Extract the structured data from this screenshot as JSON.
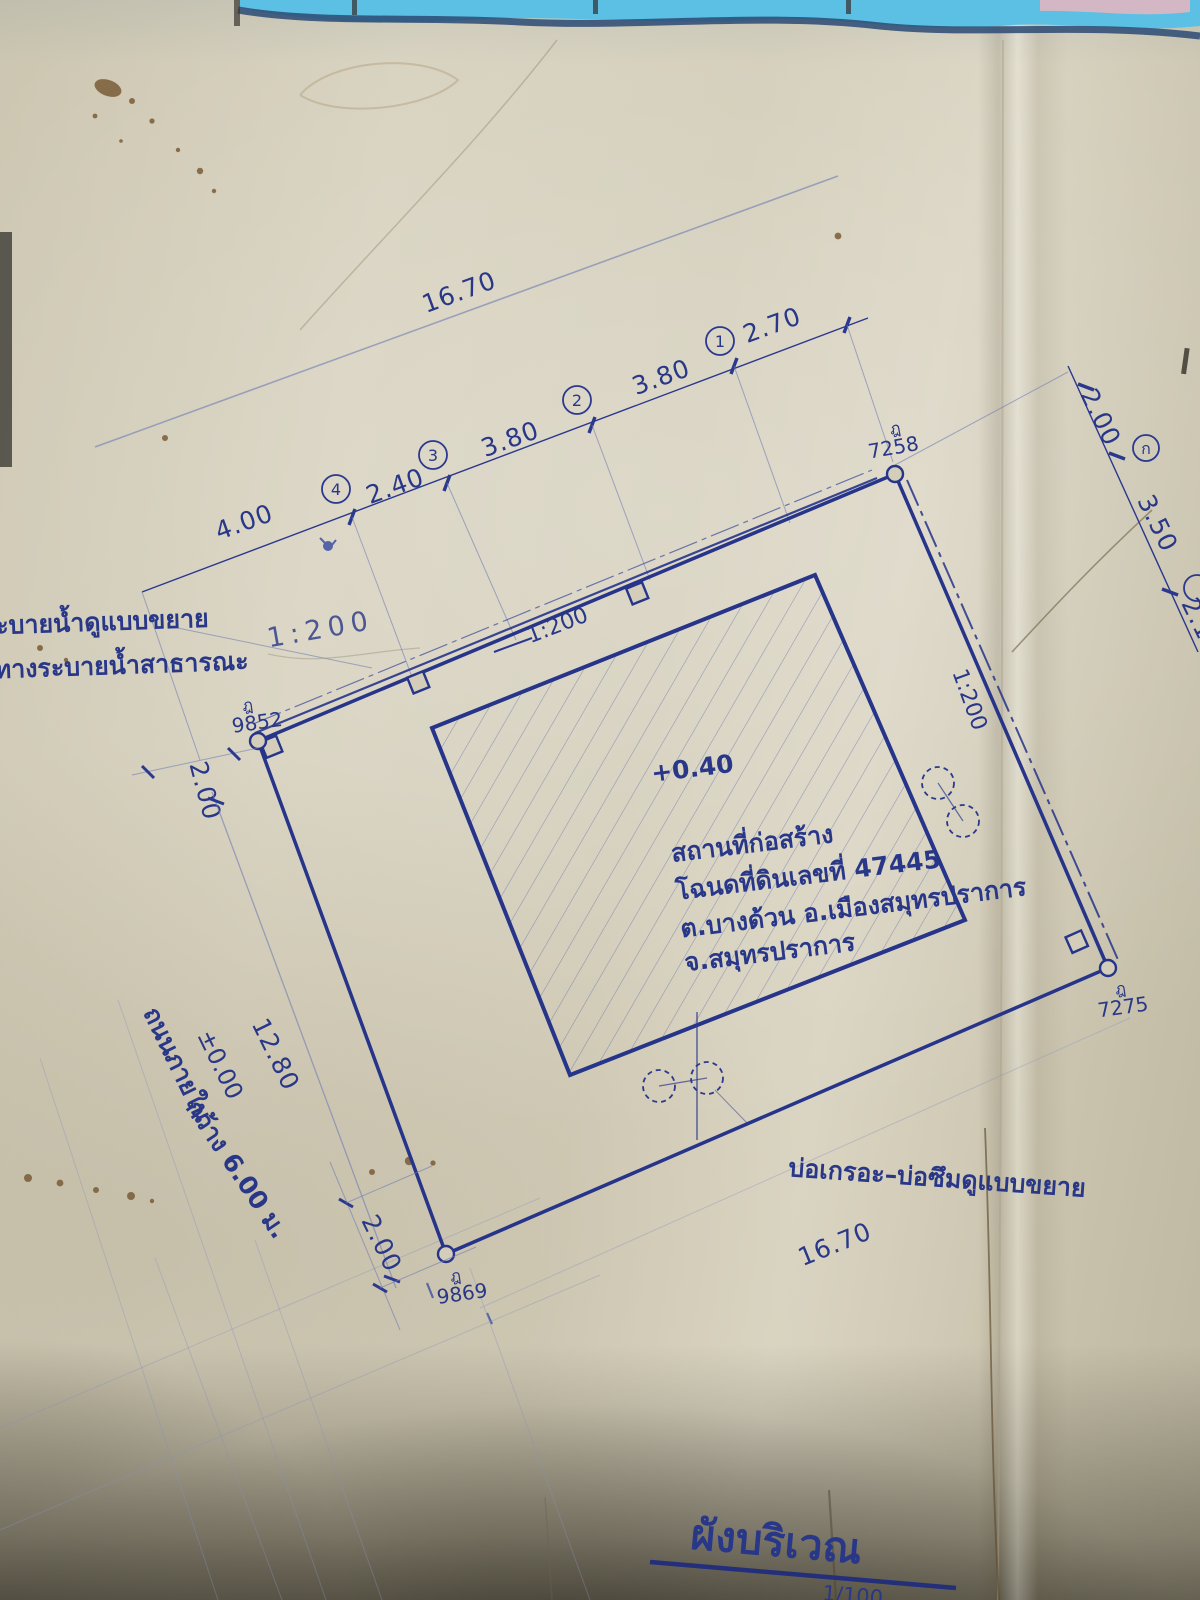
{
  "colors": {
    "ink": "#2a388e",
    "paper": "#d3cdb9",
    "sky": "#5cc0e4",
    "pink": "#d9b6c2"
  },
  "title": {
    "text": "ผังบริเวณ",
    "scale_note": "1/100"
  },
  "site_info": {
    "level": "+0.40",
    "lines": [
      "สถานที่ก่อสร้าง",
      "โฉนดที่ดินเลขที่ 47445",
      "ต.บางด้วน อ.เมืองสมุทรปราการ",
      "จ.สมุทรปราการ"
    ]
  },
  "top_dimension": {
    "total": "16.70",
    "segments": [
      "4.00",
      "2.40",
      "3.80",
      "3.80",
      "2.70"
    ],
    "stations": [
      "1",
      "2",
      "3",
      "4"
    ]
  },
  "right_dimension": {
    "segments": [
      "2.00",
      "3.50",
      "2.10"
    ],
    "station": "ก"
  },
  "boundary_markers": [
    {
      "prefix": "ฎ",
      "number": "7258"
    },
    {
      "prefix": "ฎ",
      "number": "9852"
    },
    {
      "prefix": "ฎ",
      "number": "9869"
    },
    {
      "prefix": "ฎ",
      "number": "7275"
    }
  ],
  "drain": {
    "scale_nw": "1:200",
    "scale_ne": "1:200",
    "pencil_note": "1:200"
  },
  "left_labels": {
    "line1": "ะบายน้ำดูแบบขยาย",
    "line2": "ทางระบายน้ำสาธารณะ"
  },
  "road": {
    "name": "ถนนภายใน",
    "width": "กว้าง 6.00 ม.",
    "level": "±0.00"
  },
  "side_dimensions": {
    "west": "2.00",
    "southwest": "12.80",
    "south": "2.00",
    "southeast": "16.70"
  },
  "septic_label": "บ่อเกรอะ–บ่อซึมดูแบบขยาย"
}
